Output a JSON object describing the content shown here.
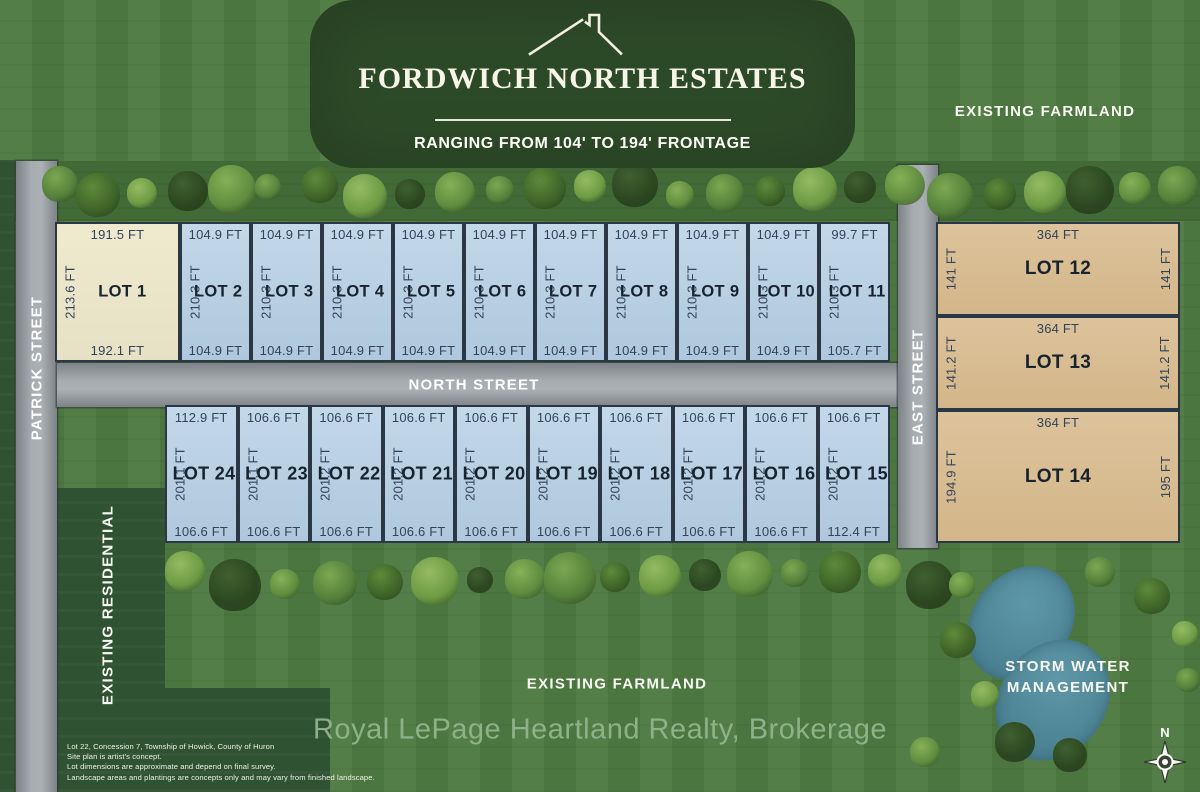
{
  "banner": {
    "title": "FORDWICH NORTH ESTATES",
    "subtitle": "RANGING FROM 104' TO 194' FRONTAGE"
  },
  "streets": {
    "left": "PATRICK STREET",
    "middle": "NORTH STREET",
    "right": "EAST STREET"
  },
  "area_labels": {
    "farmland_top": "EXISTING FARMLAND",
    "farmland_bottom": "EXISTING FARMLAND",
    "residential": "EXISTING RESIDENTIAL",
    "storm_water_line1": "STORM WATER",
    "storm_water_line2": "MANAGEMENT",
    "compass_north": "N"
  },
  "lots_top_row": [
    {
      "name": "LOT 1",
      "top": "191.5 FT",
      "side": "213.6 FT",
      "bottom": "192.1 FT",
      "variant": "cream"
    },
    {
      "name": "LOT 2",
      "top": "104.9 FT",
      "side": "210.3 FT",
      "bottom": "104.9 FT",
      "variant": "blue"
    },
    {
      "name": "LOT 3",
      "top": "104.9 FT",
      "side": "210.3 FT",
      "bottom": "104.9 FT",
      "variant": "blue"
    },
    {
      "name": "LOT 4",
      "top": "104.9 FT",
      "side": "210.3 FT",
      "bottom": "104.9 FT",
      "variant": "blue"
    },
    {
      "name": "LOT 5",
      "top": "104.9 FT",
      "side": "210.3 FT",
      "bottom": "104.9 FT",
      "variant": "blue"
    },
    {
      "name": "LOT 6",
      "top": "104.9 FT",
      "side": "210.3 FT",
      "bottom": "104.9 FT",
      "variant": "blue"
    },
    {
      "name": "LOT 7",
      "top": "104.9 FT",
      "side": "210.3 FT",
      "bottom": "104.9 FT",
      "variant": "blue"
    },
    {
      "name": "LOT 8",
      "top": "104.9 FT",
      "side": "210.3 FT",
      "bottom": "104.9 FT",
      "variant": "blue"
    },
    {
      "name": "LOT 9",
      "top": "104.9 FT",
      "side": "210.3 FT",
      "bottom": "104.9 FT",
      "variant": "blue"
    },
    {
      "name": "LOT 10",
      "top": "104.9 FT",
      "side": "210.3 FT",
      "bottom": "104.9 FT",
      "variant": "blue"
    },
    {
      "name": "LOT 11",
      "top": "99.7 FT",
      "side": "210.3 FT",
      "bottom": "105.7 FT",
      "variant": "blue"
    }
  ],
  "lots_bottom_row": [
    {
      "name": "LOT 24",
      "top": "112.9 FT",
      "side": "201.1 FT",
      "bottom": "106.6 FT"
    },
    {
      "name": "LOT 23",
      "top": "106.6 FT",
      "side": "201.1 FT",
      "bottom": "106.6 FT"
    },
    {
      "name": "LOT 22",
      "top": "106.6 FT",
      "side": "201.2 FT",
      "bottom": "106.6 FT"
    },
    {
      "name": "LOT 21",
      "top": "106.6 FT",
      "side": "201.2 FT",
      "bottom": "106.6 FT"
    },
    {
      "name": "LOT 20",
      "top": "106.6 FT",
      "side": "201.2 FT",
      "bottom": "106.6 FT"
    },
    {
      "name": "LOT 19",
      "top": "106.6 FT",
      "side": "201.2 FT",
      "bottom": "106.6 FT"
    },
    {
      "name": "LOT 18",
      "top": "106.6 FT",
      "side": "201.2 FT",
      "bottom": "106.6 FT"
    },
    {
      "name": "LOT 17",
      "top": "106.6 FT",
      "side": "201.2 FT",
      "bottom": "106.6 FT"
    },
    {
      "name": "LOT 16",
      "top": "106.6 FT",
      "side": "201.2 FT",
      "bottom": "106.6 FT"
    },
    {
      "name": "LOT 15",
      "top": "106.6 FT",
      "side": "201.2 FT",
      "bottom": "112.4 FT"
    }
  ],
  "lots_right_column": [
    {
      "name": "LOT 12",
      "top": "364 FT",
      "side_left": "141 FT",
      "side_right": "141 FT"
    },
    {
      "name": "LOT 13",
      "top": "364 FT",
      "side_left": "141.2 FT",
      "side_right": "141.2 FT"
    },
    {
      "name": "LOT 14",
      "top": "364 FT",
      "side_left": "194.9 FT",
      "side_right": "195 FT"
    }
  ],
  "footer": {
    "brokerage": "Royal LePage Heartland Realty, Brokerage",
    "disclaimer_lines": [
      "Lot 22, Concession 7, Township of Howick, County of Huron",
      "Site plan is artist's concept.",
      "Lot dimensions are approximate and depend on final survey.",
      "Landscape areas and plantings are concepts only and may vary from finished landscape."
    ]
  },
  "colors": {
    "grass": "#4e7a41",
    "banner_green": "#2d4a28",
    "dark_green": "#2f5233",
    "road_gray": "#9aa0a5",
    "lot_blue": "#b9d0e2",
    "lot_cream": "#ece8cf",
    "lot_tan": "#d9bd94",
    "pond_teal": "#4b8293",
    "dim_text": "#32435a",
    "watermark": "#95b68f"
  }
}
